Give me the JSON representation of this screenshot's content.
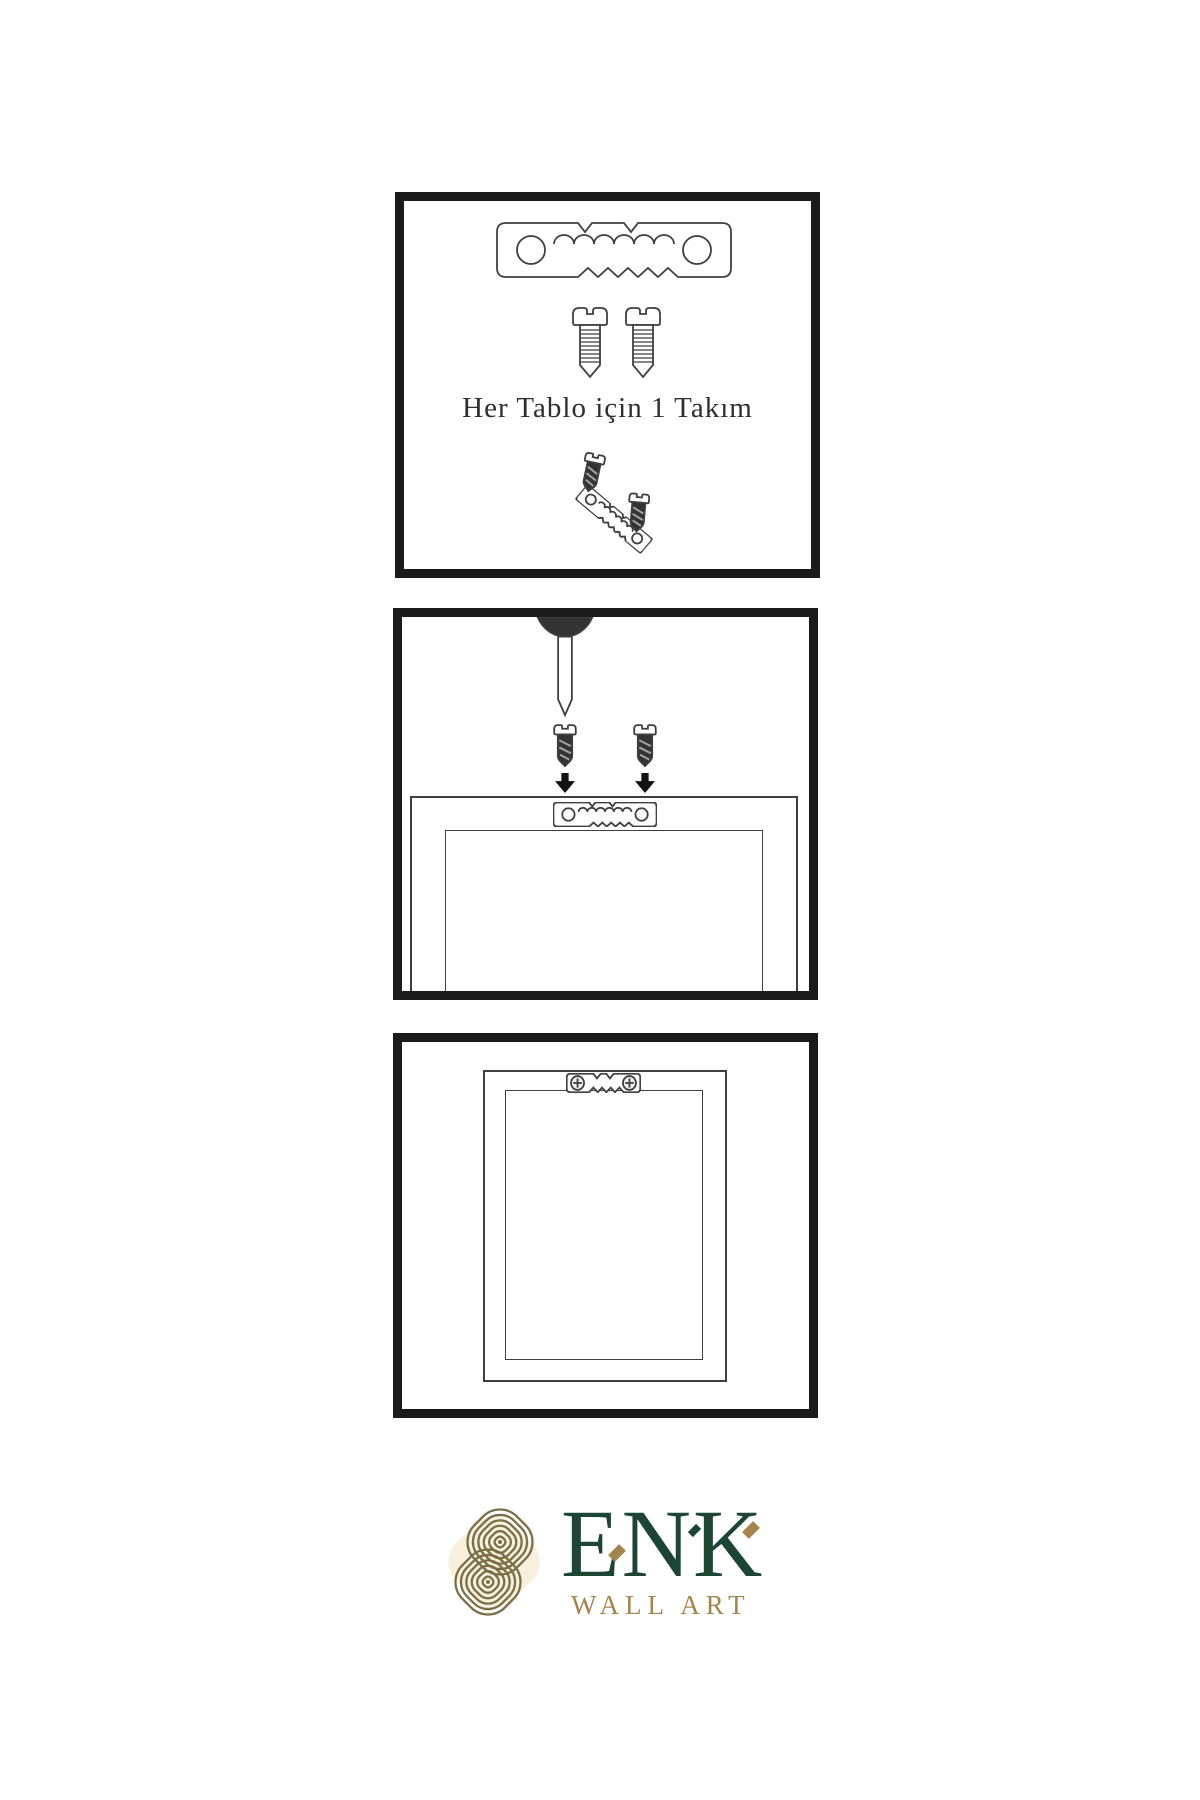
{
  "colors": {
    "paper": "#ffffff",
    "border": "#1b1b1b",
    "line": "#3f3f3f",
    "dark": "#333333",
    "arrow": "#111111",
    "green": "#1d4534",
    "gold": "#a5854c",
    "knot": "#7b6e46",
    "cream": "#f6f0dd"
  },
  "panels": [
    {
      "id": "hardware-set",
      "caption": "Her Tablo için 1 Takım",
      "icons": [
        "sawtooth-hanger-icon",
        "screw-icon",
        "screw-icon",
        "dark-screw-icon",
        "tilted-sawtooth-hanger-icon",
        "dark-screw-icon"
      ]
    },
    {
      "id": "wall-installation",
      "icons": [
        "nail-icon",
        "dark-screw-icon",
        "dark-screw-icon",
        "down-arrow-icon",
        "down-arrow-icon",
        "frame-back-icon",
        "sawtooth-hanger-icon"
      ]
    },
    {
      "id": "hanger-mounted-frame",
      "icons": [
        "frame-back-icon",
        "mounted-sawtooth-hanger-icon"
      ]
    }
  ],
  "logo": {
    "title": "ENK",
    "subtitle": "WALL ART",
    "symbol": "interlaced-knot-icon"
  }
}
